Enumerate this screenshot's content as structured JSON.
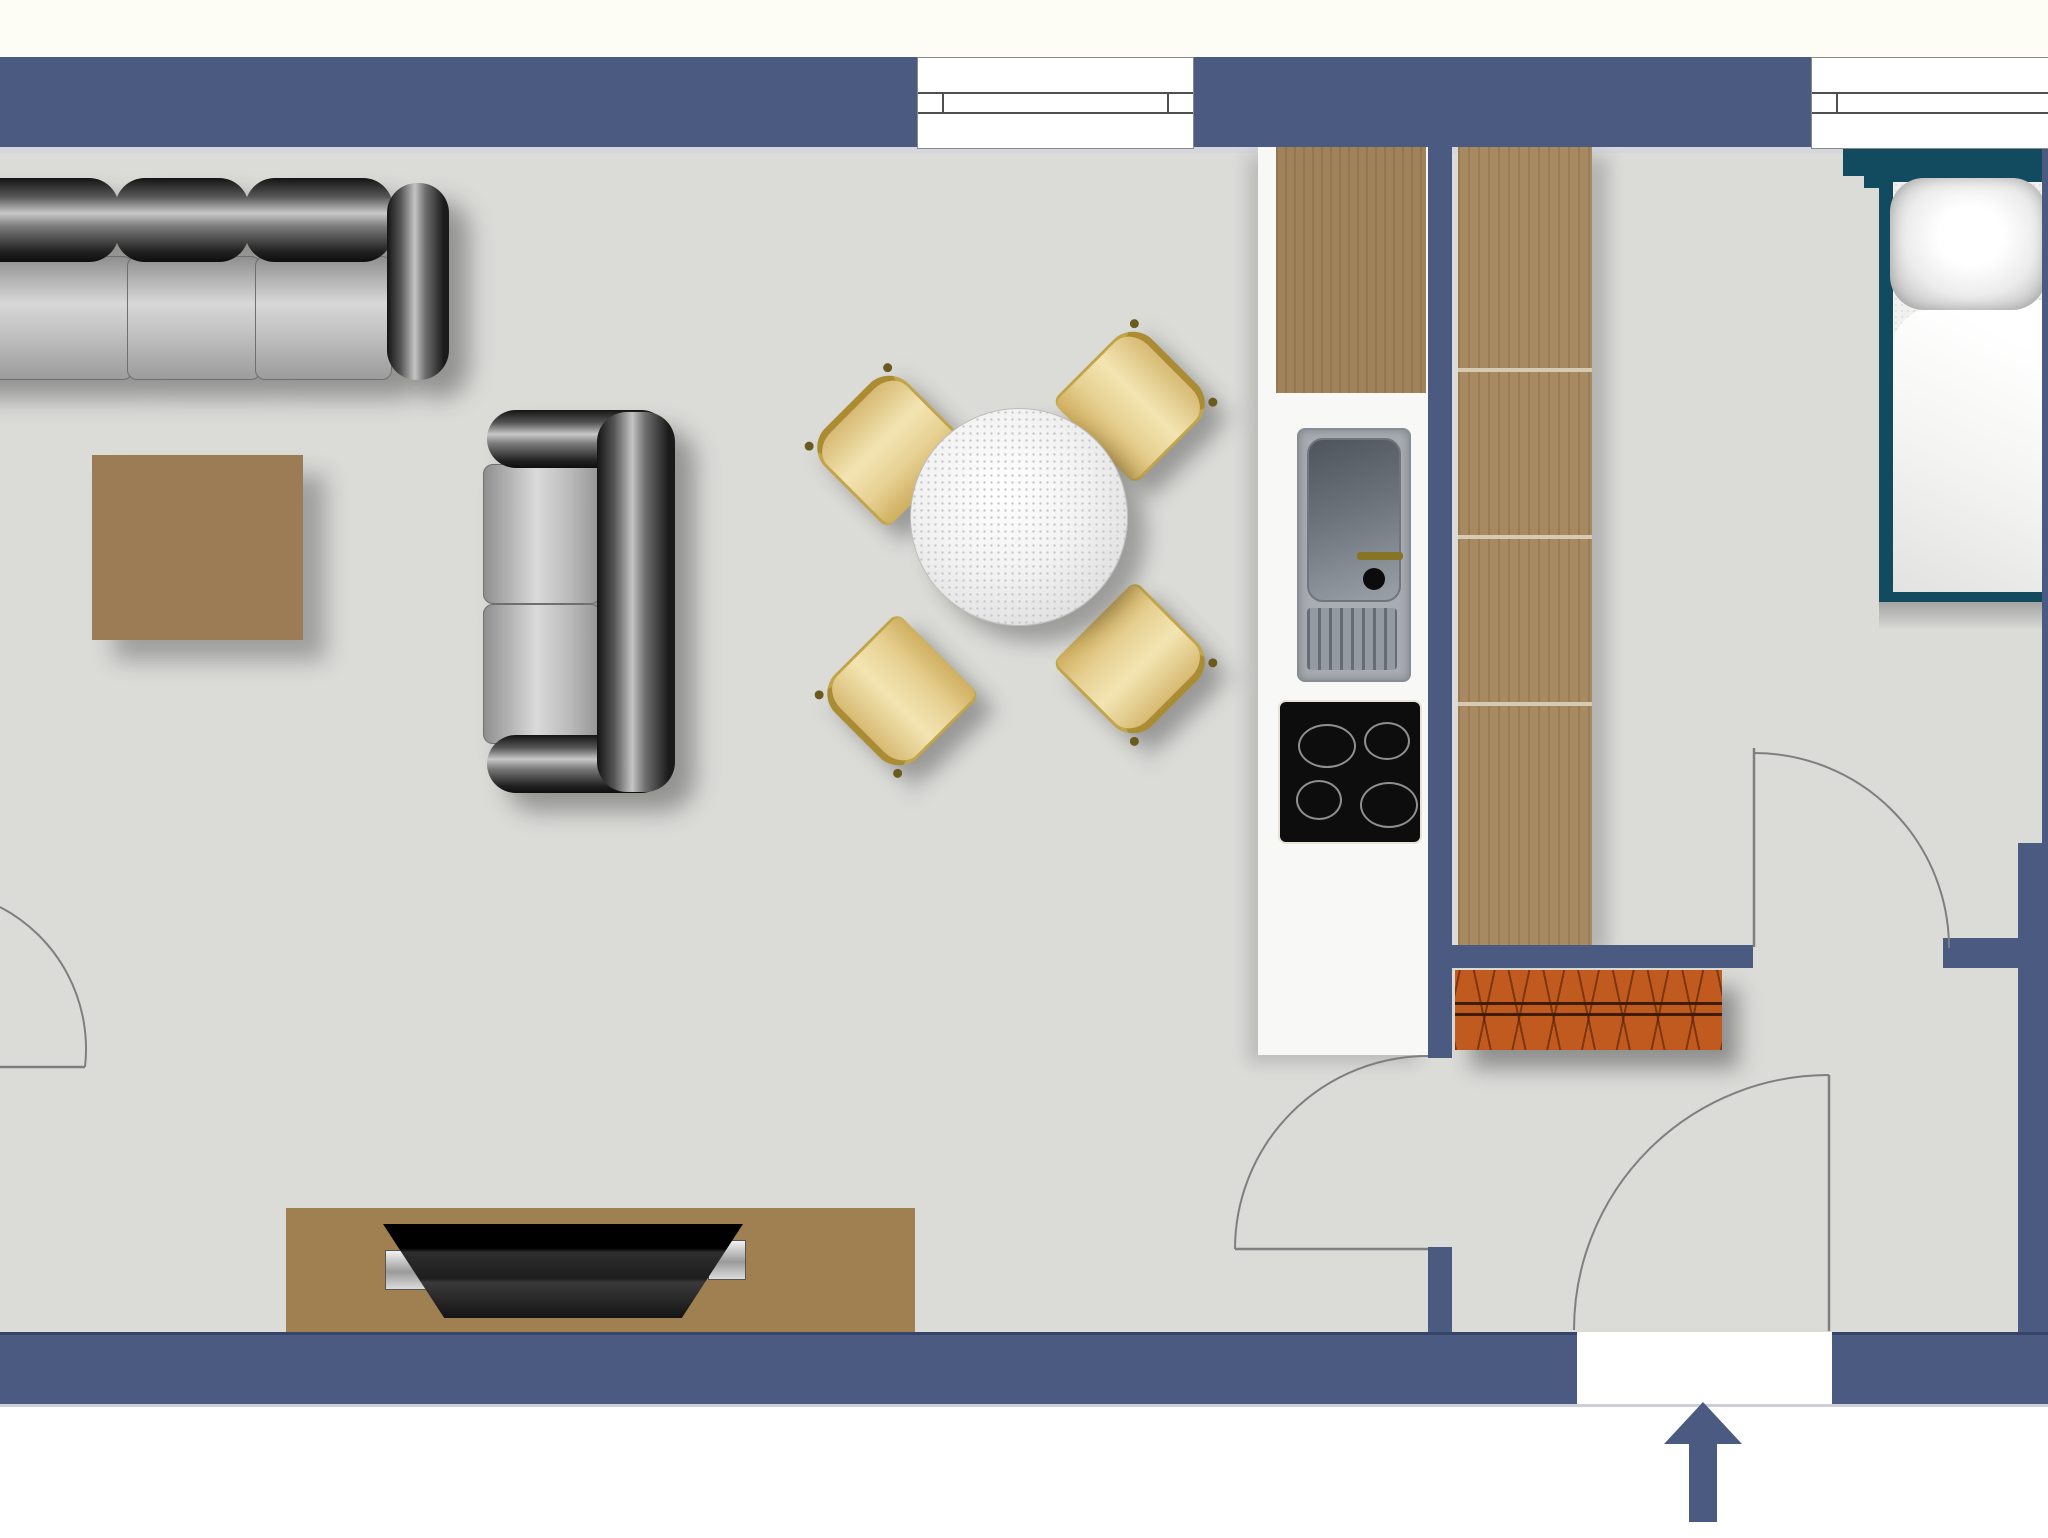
{
  "document": {
    "type": "floor-plan",
    "title": "Studio apartment floor plan (top view)",
    "visible_text": "none"
  },
  "colors": {
    "wall": "#4a5a80",
    "wall_dark": "#36446a",
    "floor": "#dbdbd8",
    "floor_strip": "#d6d6de",
    "top_strip": "#fdfdf5",
    "threshold": "#cfcfda",
    "wood": "#9c7e54",
    "wardrobe_wood": "#a28459",
    "wood_line": "#d6cab2",
    "table_brown": "#9c7c54",
    "tv_board": "#a08050",
    "bed_teal": "#124a60",
    "bench_orange": "#c05a1e",
    "chair_gold": "#ab8c33",
    "faucet_gold": "#877427",
    "sink_gray": "#a8adb3",
    "cooktop_black": "#0d0d0d",
    "arrow": "#4a5a80",
    "door_line": "#7f7f7f"
  },
  "rooms": [
    {
      "name": "living-dining-room",
      "position": "left"
    },
    {
      "name": "kitchen-niche",
      "position": "center, along dividing wall"
    },
    {
      "name": "bedroom",
      "position": "top-right"
    },
    {
      "name": "entry-hall",
      "position": "bottom-right"
    }
  ],
  "windows": [
    {
      "id": "window-top-center",
      "wall": "top",
      "panes": "double line with end ticks"
    },
    {
      "id": "window-top-right",
      "wall": "top",
      "panes": "double line with end tick, cut by image edge"
    }
  ],
  "doors": [
    {
      "id": "left-room-door",
      "type": "swing",
      "arc": "quarter-circle",
      "location": "left edge of plan"
    },
    {
      "id": "kitchen-hall-door",
      "type": "swing",
      "arc": "quarter-circle",
      "location": "dividing wall, opens into living room"
    },
    {
      "id": "bedroom-door",
      "type": "swing",
      "arc": "quarter-circle",
      "location": "bedroom wall, opens into bedroom"
    },
    {
      "id": "entry-door",
      "type": "swing",
      "arc": "quarter-circle",
      "location": "bottom wall, opens into hall"
    }
  ],
  "entrance": {
    "id": "entrance-arrow",
    "direction": "up",
    "meaning": "main entrance"
  },
  "furniture": [
    {
      "id": "sofa-3-seat",
      "room": "living-dining-room",
      "style": "black/grey leather, top-left, partially cut by image edge"
    },
    {
      "id": "loveseat-2-seat",
      "room": "living-dining-room",
      "style": "black/grey leather, vertical, back to the right"
    },
    {
      "id": "coffee-table",
      "room": "living-dining-room",
      "style": "square brown wood"
    },
    {
      "id": "dining-table-round",
      "room": "living-dining-room",
      "seats": 4,
      "style": "white granite round top"
    },
    {
      "id": "dining-chair",
      "count": 4,
      "style": "beige seat with gold frame, rotated 45deg around table"
    },
    {
      "id": "tv-sideboard",
      "room": "living-dining-room",
      "style": "brown board against bottom wall"
    },
    {
      "id": "tv-flatscreen",
      "room": "living-dining-room",
      "style": "black, on sideboard"
    },
    {
      "id": "kitchen-tall-cabinet",
      "room": "kitchen-niche",
      "style": "wood worktop section"
    },
    {
      "id": "kitchen-sink",
      "room": "kitchen-niche",
      "style": "steel bowl with faucet and drainboard"
    },
    {
      "id": "cooktop-4-burners",
      "room": "kitchen-niche",
      "burners": 4,
      "style": "black ceramic"
    },
    {
      "id": "kitchen-base-cabinet",
      "room": "kitchen-niche",
      "style": "white"
    },
    {
      "id": "wardrobe",
      "room": "bedroom",
      "style": "wood, 4 sections with shelf lines"
    },
    {
      "id": "single-bed",
      "room": "bedroom",
      "style": "teal frame, white mattress, blanket and pillow, top-right corner"
    },
    {
      "id": "shoe-bench",
      "room": "entry-hall",
      "style": "orange-red with cross-hatch pattern"
    }
  ]
}
